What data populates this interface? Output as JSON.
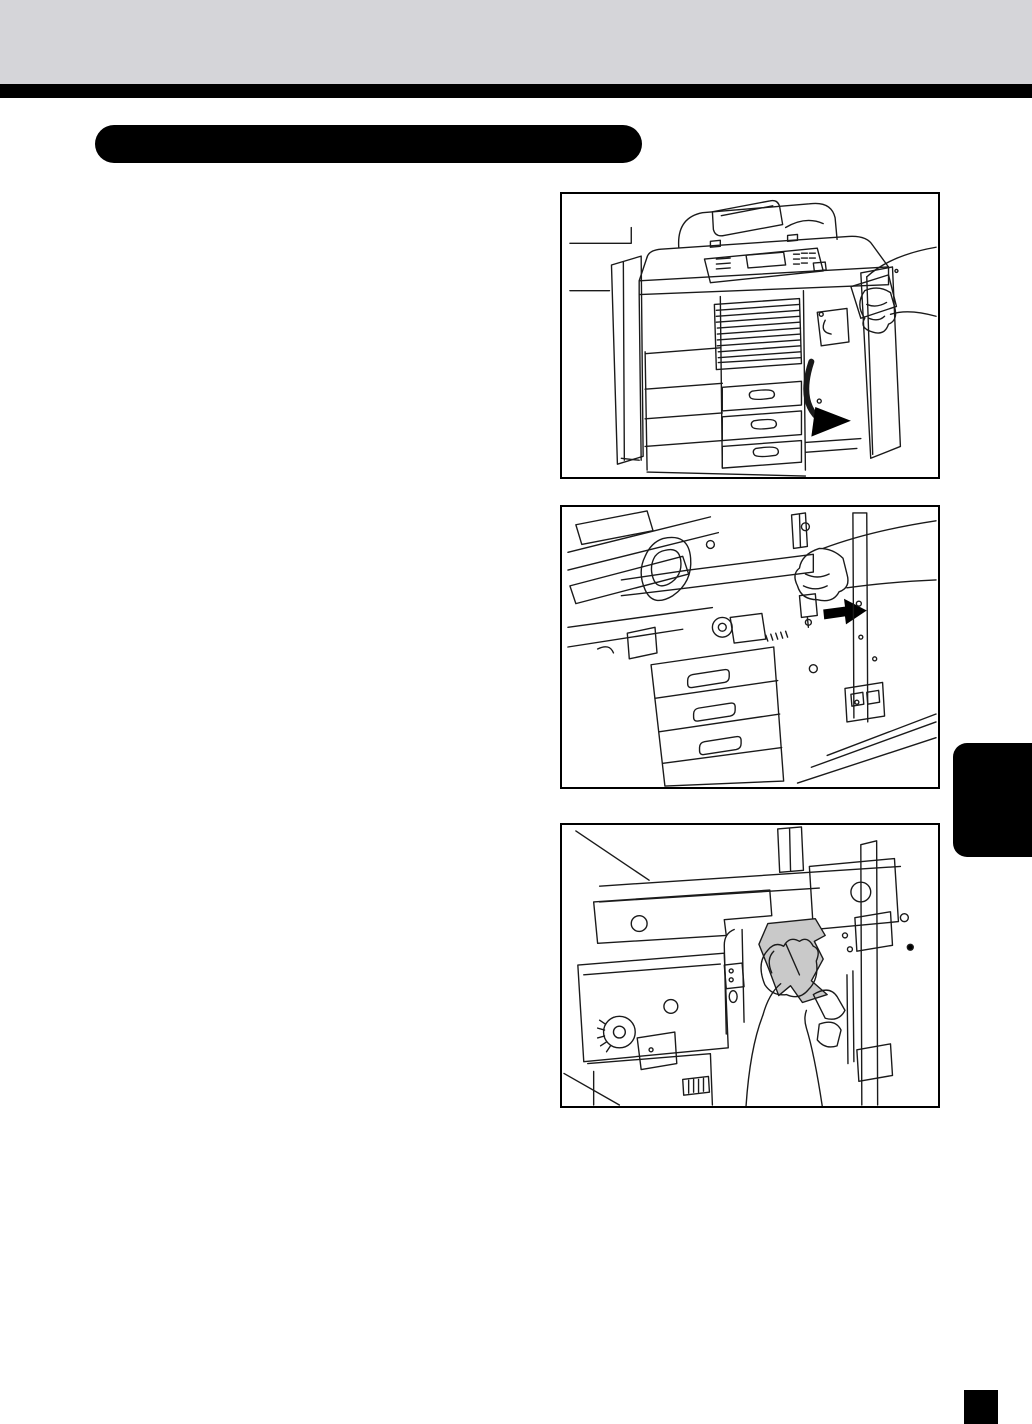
{
  "page": {
    "background": "#ffffff",
    "kind": "copier-manual-page"
  },
  "header": {
    "band_color": "#d5d5d9",
    "rule_color": "#000000"
  },
  "section_title_pill": {
    "text": "",
    "color": "#000000"
  },
  "figures": [
    {
      "id": "step-1",
      "alt": "Copier exterior - hand opening the right-hand side cover; curved arrow shows the cover swinging open"
    },
    {
      "id": "step-2",
      "alt": "Inside the opened side cover - hand slides the release lever; solid black arrow points to the right"
    },
    {
      "id": "step-3",
      "alt": "Hand pulling a jammed sheet of paper (shaded gray) out of the paper-feed area"
    }
  ],
  "illustration_colors": {
    "line": "#1a1a1a",
    "paper_shade": "#c9c9c9",
    "arrow": "#000000"
  },
  "chapter_tab": {
    "text": "",
    "color": "#000000"
  },
  "page_number_block": {
    "text": "",
    "color": "#000000"
  }
}
